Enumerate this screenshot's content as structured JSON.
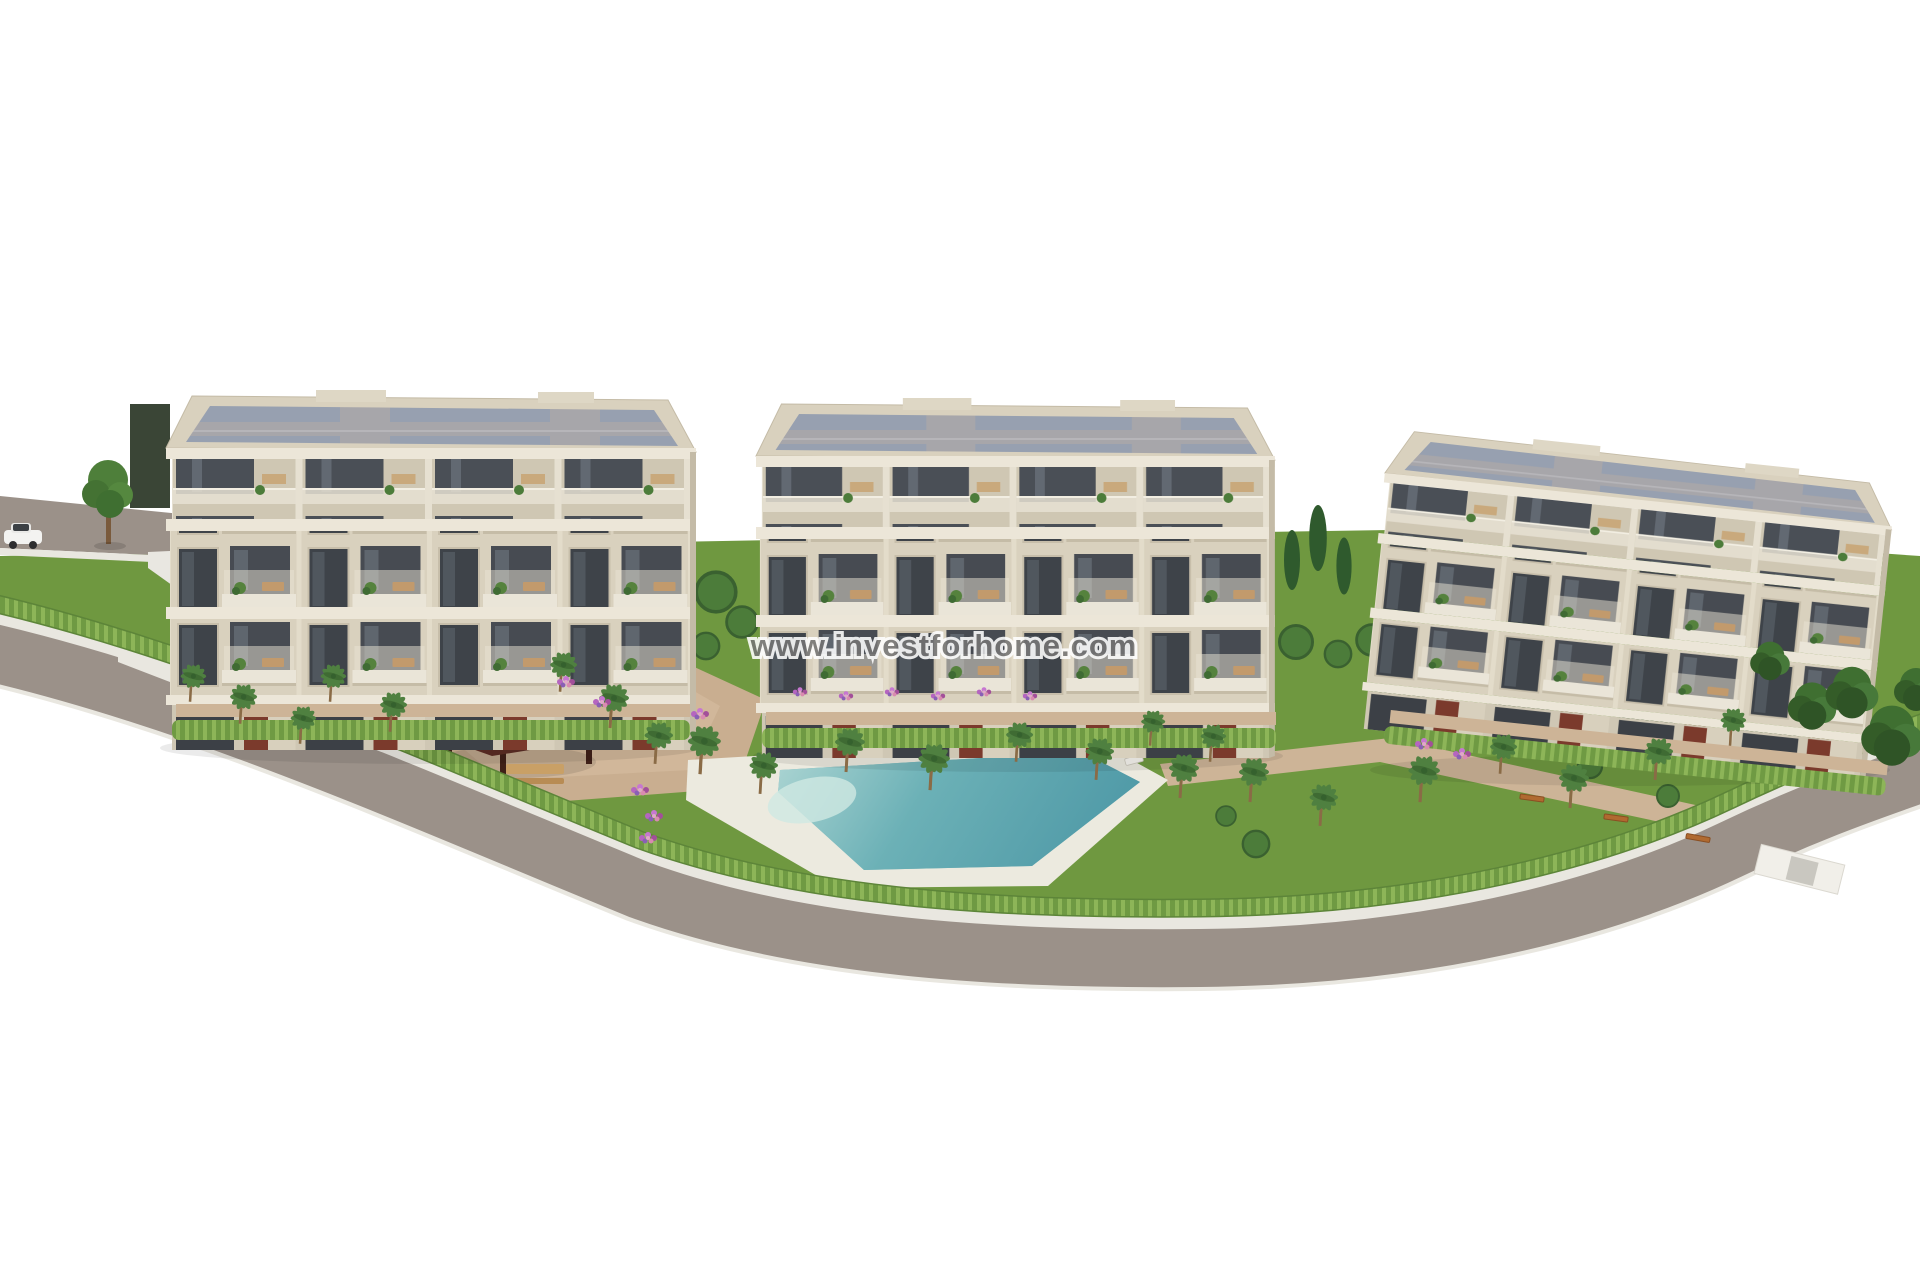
{
  "image": {
    "type": "architectural-3d-render",
    "subject": "Aerial view of a new-build residential complex: three cream apartment blocks with balconies, communal gardens, palm trees, pergola and swimming pool, wrapped by a curving road",
    "background": "#ffffff"
  },
  "watermark": {
    "text": "www.investforhome.com"
  },
  "scene": {
    "buildings_count": 3,
    "pool_count": 1,
    "pergola_count": 1,
    "car_count": 1,
    "umbrella_count": 4
  },
  "palette": {
    "sky": "#ffffff",
    "facade": "#d9d1be",
    "facade_recessed": "#cfc7b3",
    "slab": "#ece6d8",
    "roof_deck": "#a7a6aa",
    "roof_panel": "#97a0b0",
    "window_glass": "#3e4349",
    "accent_red": "#7b3a2c",
    "grass": "#6f9840",
    "hedge": "#6f9a43",
    "hedge_light": "#8db558",
    "palm_frond": "#4f8040",
    "pool_water": "#5fa8b0",
    "pool_shallow": "#cfe8e2",
    "pool_deck": "#eceadf",
    "path": "#c9ae90",
    "walk": "#cdb497",
    "road": "#9b9189",
    "curb": "#e9e7e0",
    "pergola_roof": "#5c2d24",
    "wood": "#c9a066",
    "car_body": "#f3f3f1",
    "watermark_color": "#757575"
  }
}
